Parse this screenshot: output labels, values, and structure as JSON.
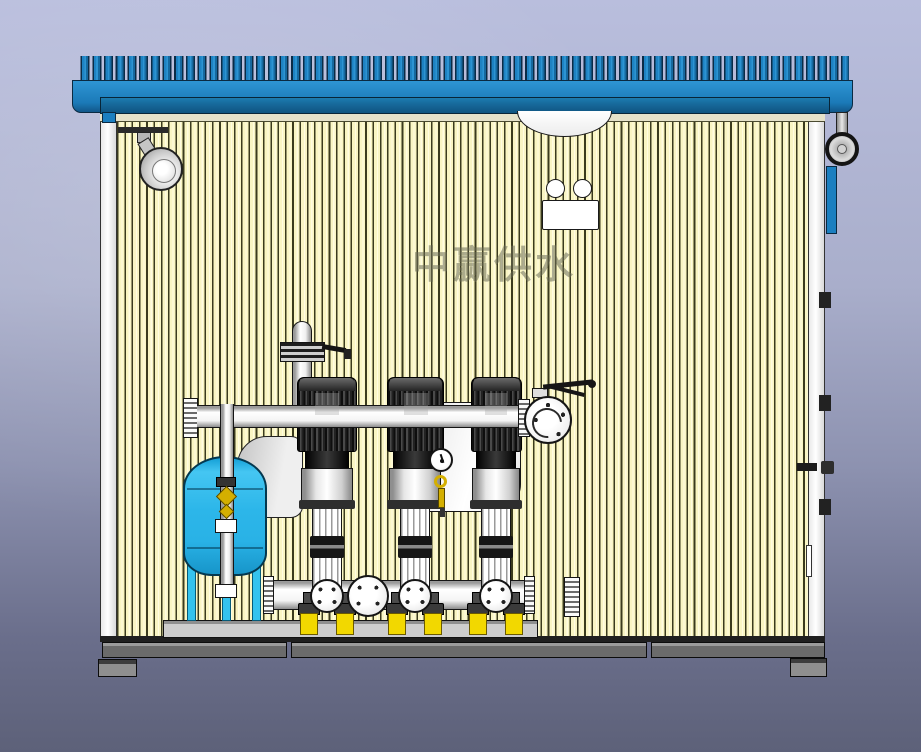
{
  "watermark": {
    "text": "中赢供水"
  },
  "equipment": {
    "pump_count": 3,
    "pressure_tank_count": 1,
    "visible_components": [
      "corrugated-roof",
      "striped-wall-panels",
      "interior-spotlight",
      "ceiling-lamp-dome",
      "junction-box",
      "exhaust-fan",
      "side-panel",
      "door-hinges",
      "door-handle",
      "pressure-tank",
      "tank-inlet-pipe",
      "brass-valve",
      "discharge-manifold",
      "header-body",
      "butterfly-valve",
      "air-vent-standpipe",
      "pressure-gauge",
      "vertical-multistage-pumps",
      "suction-manifold",
      "blind-flange",
      "vibration-pads",
      "equipment-platform",
      "base-frame",
      "support-feet"
    ]
  },
  "colors": {
    "bg_top": "#b9bedd",
    "bg_bottom": "#5d6179",
    "roof_blue": "#1b7fc0",
    "roof_blue_deep": "#145e8e",
    "roof_fascia": "#17699b",
    "wall_yellow": "#f9f5c3",
    "wall_stripe": "#3b3b1e",
    "tank_blue": "#2cb6e9",
    "tank_leg": "#35c3ee",
    "platform_gray": "#cdcdcd",
    "frame_gray": "#6b6b6b",
    "foot_gray": "#8f8f8f",
    "pad_yellow": "#f2d800",
    "brass": "#d4af00",
    "metal_dark": "#2b2b2b",
    "pipe_white": "#fdfdfd",
    "outline": "#151515"
  }
}
